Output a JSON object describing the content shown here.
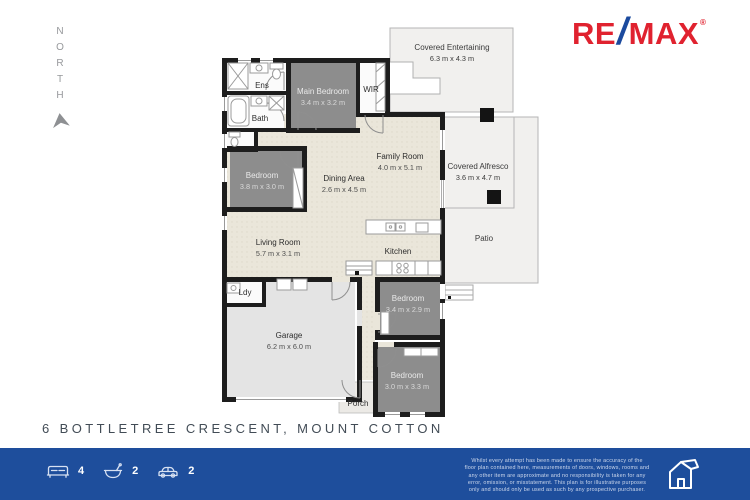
{
  "north_label": "NORTH",
  "brand": {
    "re": "RE",
    "slash": "/",
    "max": "MAX",
    "reg": "®"
  },
  "rooms": {
    "covered_entertaining": {
      "name": "Covered Entertaining",
      "dims": "6.3 m x 4.3 m"
    },
    "main_bedroom": {
      "name": "Main Bedroom",
      "dims": "3.4 m x 3.2 m"
    },
    "ens": {
      "name": "Ens"
    },
    "wir": {
      "name": "WIR"
    },
    "bath": {
      "name": "Bath"
    },
    "bedroom_left": {
      "name": "Bedroom",
      "dims": "3.8 m x 3.0 m"
    },
    "dining": {
      "name": "Dining Area",
      "dims": "2.6 m x 4.5 m"
    },
    "family": {
      "name": "Family Room",
      "dims": "4.0 m x 5.1 m"
    },
    "alfresco": {
      "name": "Covered Alfresco",
      "dims": "3.6 m x 4.7 m"
    },
    "patio": {
      "name": "Patio"
    },
    "living": {
      "name": "Living Room",
      "dims": "5.7 m x 3.1 m"
    },
    "kitchen": {
      "name": "Kitchen"
    },
    "laundry": {
      "name": "Ldy"
    },
    "garage": {
      "name": "Garage",
      "dims": "6.2 m x 6.0 m"
    },
    "bedroom_mid": {
      "name": "Bedroom",
      "dims": "3.4 m x 2.9 m"
    },
    "bedroom_bottom": {
      "name": "Bedroom",
      "dims": "3.0 m x 3.3 m"
    },
    "porch": {
      "name": "Porch"
    }
  },
  "address": "6 BOTTLETREE CRESCENT, MOUNT COTTON",
  "features": {
    "beds": "4",
    "baths": "2",
    "cars": "2"
  },
  "disclaimer": "Whilst every attempt has been made to ensure the accuracy of the\nfloor plan contained here, measurements of doors, windows, rooms and\nany other item are approximate and no responsibility is taken for any\nerror, omission, or misstatement. This plan is for illustrative purposes\nonly and should only be used as such by any prospective purchaser.",
  "colors": {
    "remax_red": "#E0222F",
    "remax_blue": "#1B4A9E",
    "footer_bg": "#1E4E9C",
    "wall": "#1D1D1D",
    "bedroom_fill": "#8D8D8D",
    "floor_fill": "#EAE6DA",
    "garage_fill": "#E4E4E4",
    "outdoor_fill": "#F1F0EE"
  }
}
